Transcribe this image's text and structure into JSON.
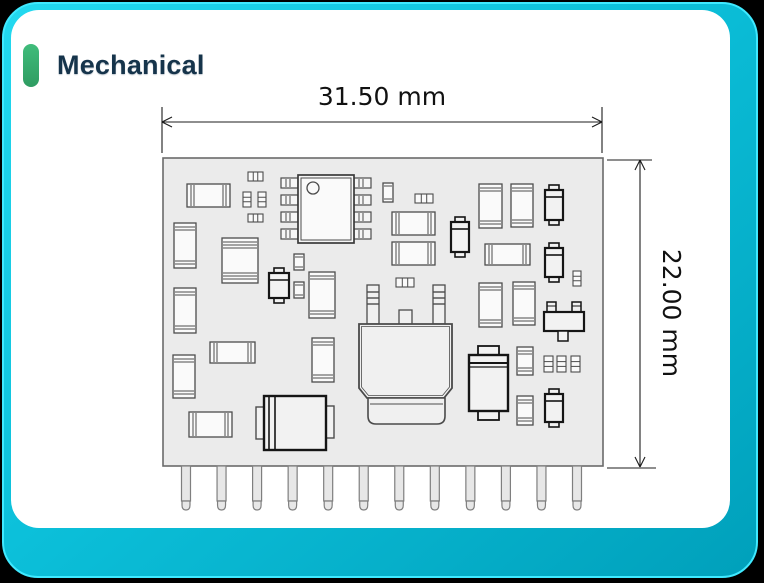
{
  "section": {
    "title": "Mechanical"
  },
  "colors": {
    "frame_outer_edge": "#3fe9ff",
    "frame_fill_start": "#23d9f0",
    "frame_fill_end": "#00a0bb",
    "accent_green": "#3cb475",
    "title_navy": "#16344b",
    "board_fill": "#ebebeb",
    "board_stroke": "#6b6b6b",
    "component_stroke": "#4c4c4c",
    "component_dark_stroke": "#151515",
    "dimension_stroke": "#1c1c1c"
  },
  "drawing": {
    "width_label": "31.50 mm",
    "height_label": "22.00 mm",
    "board": {
      "x": 163,
      "y": 158,
      "w": 440,
      "h": 308
    },
    "pins": {
      "count": 12,
      "first_cx": 186,
      "last_cx": 577,
      "top": 466,
      "body_h": 35,
      "tip_h": 9,
      "w": 9
    },
    "dims": {
      "horizontal": {
        "ext": [
          [
            162,
            107,
            162,
            153
          ],
          [
            602,
            107,
            602,
            153
          ]
        ],
        "line": [
          162,
          122,
          602,
          122
        ],
        "label_x": 382,
        "label_y": 105
      },
      "vertical": {
        "ext": [
          [
            607,
            160,
            652,
            160
          ],
          [
            607,
            468,
            656,
            468
          ]
        ],
        "line": [
          640,
          160,
          640,
          467
        ],
        "label_x": 663,
        "label_y": 313
      }
    },
    "components": [
      {
        "t": "resh",
        "x": 187,
        "y": 184,
        "w": 43,
        "h": 23
      },
      {
        "t": "tinyh",
        "x": 248,
        "y": 172,
        "w": 15,
        "h": 9
      },
      {
        "t": "tinyv",
        "x": 243,
        "y": 192,
        "w": 8,
        "h": 15
      },
      {
        "t": "tinyv",
        "x": 258,
        "y": 192,
        "w": 8,
        "h": 15
      },
      {
        "t": "tinyh",
        "x": 248,
        "y": 214,
        "w": 15,
        "h": 8
      },
      {
        "t": "chip8",
        "x": 298,
        "y": 175,
        "w": 56,
        "h": 68
      },
      {
        "t": "capv",
        "x": 383,
        "y": 183,
        "w": 10,
        "h": 19
      },
      {
        "t": "tinyh",
        "x": 415,
        "y": 194,
        "w": 18,
        "h": 9
      },
      {
        "t": "resh",
        "x": 392,
        "y": 212,
        "w": 43,
        "h": 23
      },
      {
        "t": "resh",
        "x": 392,
        "y": 242,
        "w": 43,
        "h": 23
      },
      {
        "t": "tinyh",
        "x": 396,
        "y": 278,
        "w": 18,
        "h": 9
      },
      {
        "t": "capv",
        "x": 174,
        "y": 223,
        "w": 22,
        "h": 45
      },
      {
        "t": "tant",
        "x": 222,
        "y": 238,
        "w": 36,
        "h": 45
      },
      {
        "t": "capv",
        "x": 174,
        "y": 288,
        "w": 22,
        "h": 45
      },
      {
        "t": "diodev",
        "x": 451,
        "y": 217,
        "w": 18,
        "h": 40
      },
      {
        "t": "capv",
        "x": 479,
        "y": 184,
        "w": 23,
        "h": 44
      },
      {
        "t": "capv",
        "x": 511,
        "y": 184,
        "w": 22,
        "h": 43
      },
      {
        "t": "diodev",
        "x": 545,
        "y": 185,
        "w": 18,
        "h": 40
      },
      {
        "t": "resh",
        "x": 485,
        "y": 244,
        "w": 45,
        "h": 21
      },
      {
        "t": "diodev",
        "x": 545,
        "y": 243,
        "w": 18,
        "h": 39
      },
      {
        "t": "tinyv",
        "x": 573,
        "y": 271,
        "w": 8,
        "h": 15
      },
      {
        "t": "capv",
        "x": 479,
        "y": 283,
        "w": 23,
        "h": 44
      },
      {
        "t": "capv",
        "x": 513,
        "y": 282,
        "w": 22,
        "h": 43
      },
      {
        "t": "sot23",
        "x": 544,
        "y": 302,
        "w": 40,
        "h": 39
      },
      {
        "t": "diodev",
        "x": 269,
        "y": 268,
        "w": 20,
        "h": 35
      },
      {
        "t": "capv",
        "x": 294,
        "y": 254,
        "w": 10,
        "h": 16
      },
      {
        "t": "capv",
        "x": 294,
        "y": 282,
        "w": 10,
        "h": 16
      },
      {
        "t": "capv",
        "x": 309,
        "y": 272,
        "w": 26,
        "h": 46
      },
      {
        "t": "capv",
        "x": 312,
        "y": 338,
        "w": 22,
        "h": 44
      },
      {
        "t": "resh",
        "x": 210,
        "y": 342,
        "w": 45,
        "h": 21
      },
      {
        "t": "capv",
        "x": 173,
        "y": 355,
        "w": 22,
        "h": 43
      },
      {
        "t": "resh",
        "x": 189,
        "y": 412,
        "w": 43,
        "h": 25
      },
      {
        "t": "elech",
        "x": 256,
        "y": 396,
        "w": 78,
        "h": 54
      },
      {
        "t": "power",
        "x": 359,
        "y": 285,
        "w": 93,
        "h": 139
      },
      {
        "t": "elecv",
        "x": 469,
        "y": 346,
        "w": 39,
        "h": 74
      },
      {
        "t": "capv",
        "x": 517,
        "y": 347,
        "w": 16,
        "h": 28
      },
      {
        "t": "tinyv",
        "x": 544,
        "y": 356,
        "w": 9,
        "h": 16
      },
      {
        "t": "tinyv",
        "x": 557,
        "y": 356,
        "w": 9,
        "h": 16
      },
      {
        "t": "tinyv",
        "x": 571,
        "y": 356,
        "w": 9,
        "h": 16
      },
      {
        "t": "capv",
        "x": 517,
        "y": 396,
        "w": 16,
        "h": 29
      },
      {
        "t": "diodev",
        "x": 545,
        "y": 389,
        "w": 18,
        "h": 38
      }
    ]
  }
}
